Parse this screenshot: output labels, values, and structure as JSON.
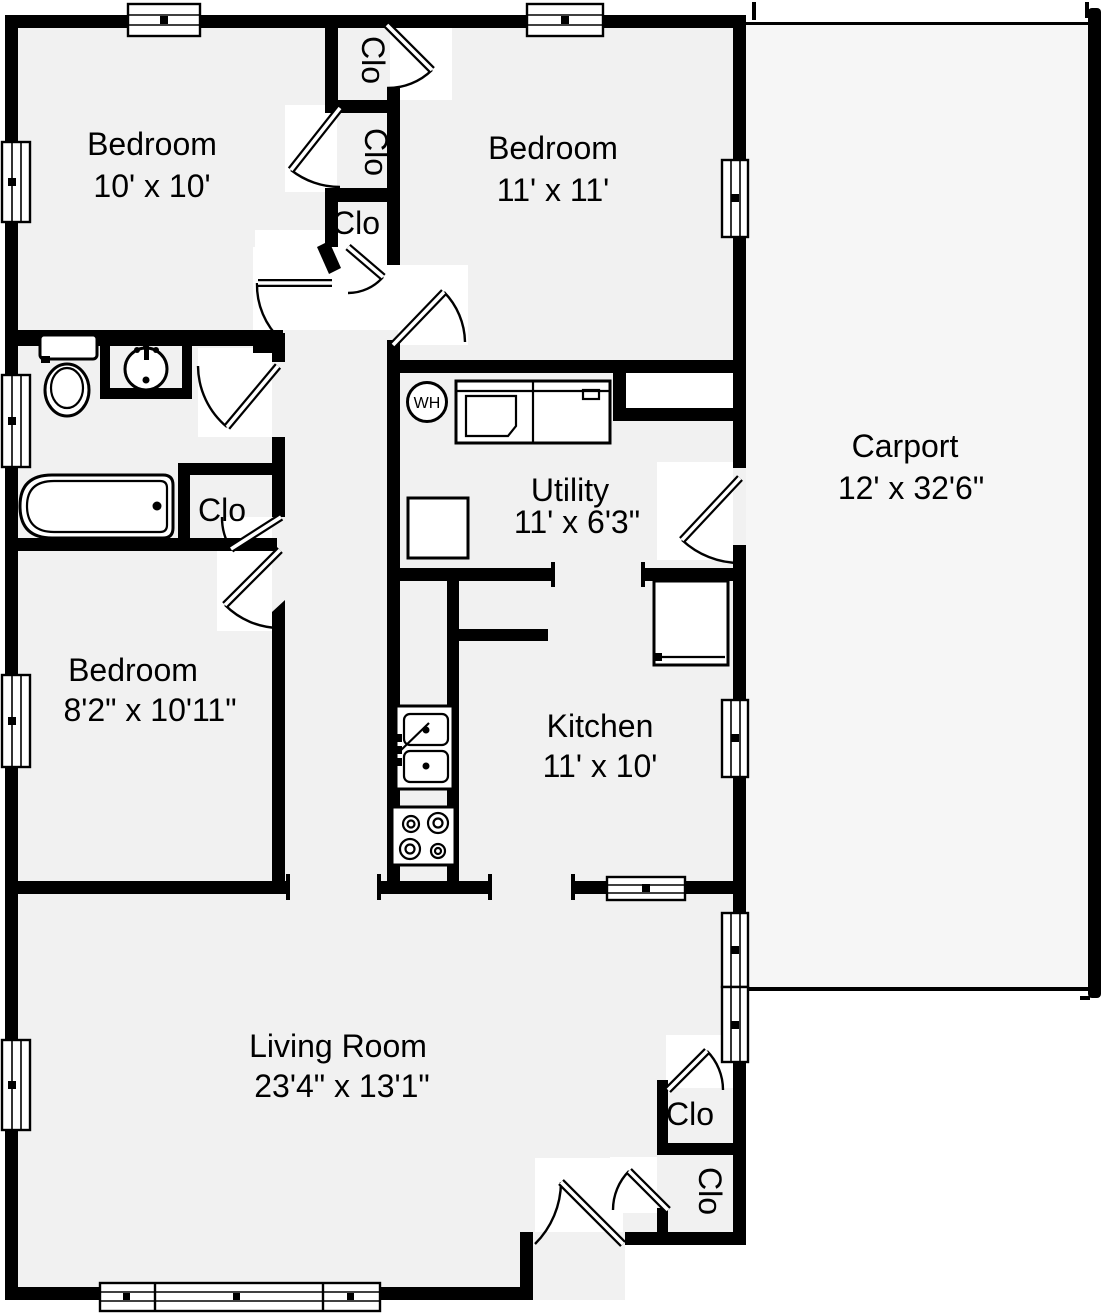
{
  "title": "House floor plan",
  "colors": {
    "wall": "#000000",
    "room_floor": "#f1f1f1",
    "carport_floor": "#f6f6f6",
    "background": "#ffffff",
    "fixture_fill": "#ffffff"
  },
  "rooms": [
    {
      "name": "Bedroom",
      "dims": "10' x 10'"
    },
    {
      "name": "Bedroom",
      "dims": "11' x 11'"
    },
    {
      "name": "Carport",
      "dims": "12' x 32'6\""
    },
    {
      "name": "Utility",
      "dims": "11' x 6'3\""
    },
    {
      "name": "Bedroom",
      "dims": "8'2\" x 10'11\""
    },
    {
      "name": "Kitchen",
      "dims": "11' x 10'"
    },
    {
      "name": "Living Room",
      "dims": "23'4\" x 13'1\""
    }
  ],
  "closets": {
    "label": "Clo"
  },
  "fixtures": {
    "water_heater_label": "WH"
  }
}
